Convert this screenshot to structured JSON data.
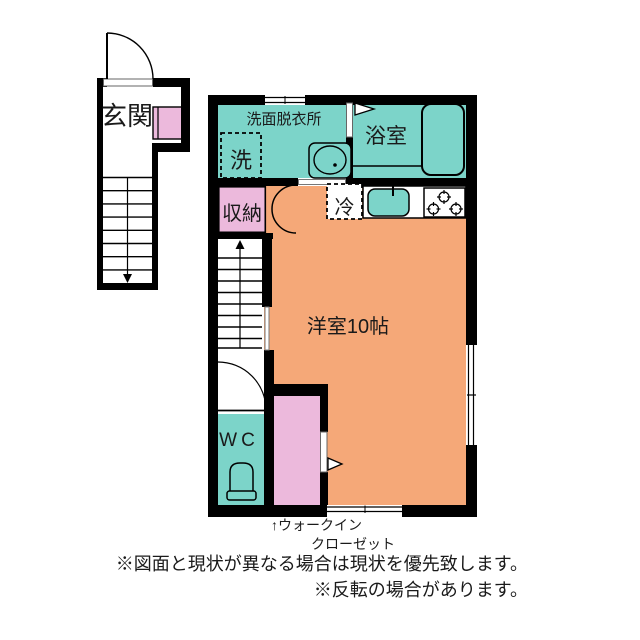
{
  "rooms": {
    "genkan": "玄関",
    "washroom": "洗面脱衣所",
    "washer": "洗",
    "bath": "浴室",
    "storage": "収納",
    "fridge": "冷",
    "main_room": "洋室10帖",
    "wc": "WC"
  },
  "annotations": {
    "closet_line1": "↑ウォークイン",
    "closet_line2": "クローゼット",
    "note1": "※図面と現状が異なる場合は現状を優先致します。",
    "note2": "※反転の場合があります。"
  },
  "colors": {
    "wet_area": "#7CD4C9",
    "living": "#F5A878",
    "closet": "#ECB9DC",
    "wall": "#000000"
  }
}
